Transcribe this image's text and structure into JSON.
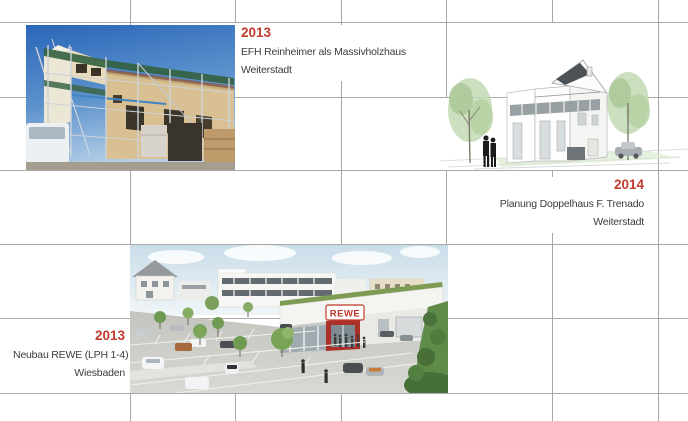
{
  "projects": [
    {
      "year": "2013",
      "title": "EFH Reinheimer als Massivholzhaus",
      "location": "Weiterstadt",
      "image": "construction-photo"
    },
    {
      "year": "2014",
      "title": "Planung Doppelhaus F. Trenado",
      "location": "Weiterstadt",
      "image": "doppelhaus-rendering"
    },
    {
      "year": "2013",
      "title": "Neubau REWE (LPH 1-4)",
      "location": "Wiesbaden",
      "image": "rewe-rendering"
    }
  ],
  "images": [
    {
      "name": "construction-photo",
      "label": "Baustellenfoto EFH mit Gerüst"
    },
    {
      "name": "doppelhaus-rendering",
      "label": "Architektur-Rendering Doppelhaus"
    },
    {
      "name": "rewe-rendering",
      "label": "Rendering REWE Markt mit Parkplatz"
    }
  ],
  "rewe_sign_text": "REWE",
  "colors": {
    "year_accent": "#c23a2c",
    "caption_text": "#3c3c3c",
    "grid_line": "#a8a8a8",
    "background": "#ffffff"
  }
}
